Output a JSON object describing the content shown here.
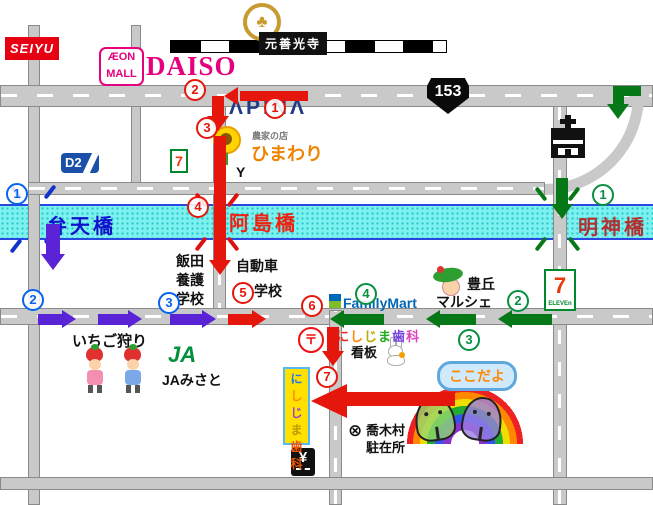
{
  "stores": {
    "seiyu": "SEIYU",
    "aeon_top": "ÆON",
    "aeon_bottom": "MALL",
    "daiso": "DAISO",
    "motozenkoji": "元善光寺",
    "route_153": "153",
    "apina": "ΛPINΛ",
    "himawari_sub": "農家の店",
    "himawari": "ひまわり",
    "d2": "D2",
    "seven_small": "7",
    "y_junction": "Y",
    "seven_big": "7",
    "seven_big_sub": "ELEVEn",
    "familymart": "FamilyMart",
    "marche_top": "豊丘",
    "marche_bottom": "マルシェ",
    "ichigo": "いちご狩り",
    "ja_mark": "JA",
    "ja_misato": "JAみさと",
    "yen": "¥",
    "post": "〒"
  },
  "bridges": {
    "benten": "弁天橋",
    "ashima": "阿島橋",
    "myojin": "明神橋"
  },
  "schools": {
    "iida": [
      "飯田",
      "養護",
      "学校"
    ],
    "driving": [
      "自動車",
      "学校"
    ]
  },
  "clinic": {
    "board_chars": [
      {
        "ch": "に",
        "color": "#ee2222"
      },
      {
        "ch": "し",
        "color": "#ff8800"
      },
      {
        "ch": "じ",
        "color": "#bbaa00"
      },
      {
        "ch": "ま",
        "color": "#22aa22"
      },
      {
        "ch": "歯",
        "color": "#7744dd"
      },
      {
        "ch": "科",
        "color": "#dd44bb"
      }
    ],
    "board_label": "看板",
    "sign_chars": [
      {
        "ch": "に",
        "color": "#2277ee"
      },
      {
        "ch": "し",
        "color": "#ff8800"
      },
      {
        "ch": "じ",
        "color": "#9944cc"
      },
      {
        "ch": "ま",
        "color": "#bb9900"
      },
      {
        "ch": "歯",
        "color": "#ee5500"
      },
      {
        "ch": "科",
        "color": "#ee5500"
      }
    ],
    "bubble": "ここだよ",
    "police_lines": [
      "喬木村",
      "駐在所"
    ]
  },
  "markers": {
    "red": [
      "1",
      "2",
      "3",
      "4",
      "5",
      "6",
      "7"
    ],
    "blue": [
      "1",
      "2",
      "3"
    ],
    "green": [
      "1",
      "2",
      "3",
      "4"
    ]
  },
  "icons": {
    "temple_crest": "♣",
    "police": "⊗",
    "down_arrow": "↓"
  },
  "colors": {
    "route_red": "#e5160c",
    "route_purple": "#5a23d6",
    "route_green": "#067818",
    "marker_blue": "#0663f0",
    "river_cyan": "#7df0f0",
    "seiyu_red": "#e60012",
    "aeon_pink": "#e6007e",
    "apina_navy": "#1f3c88",
    "himawari_orange": "#f08300",
    "familymart_blue": "#0068b7"
  }
}
